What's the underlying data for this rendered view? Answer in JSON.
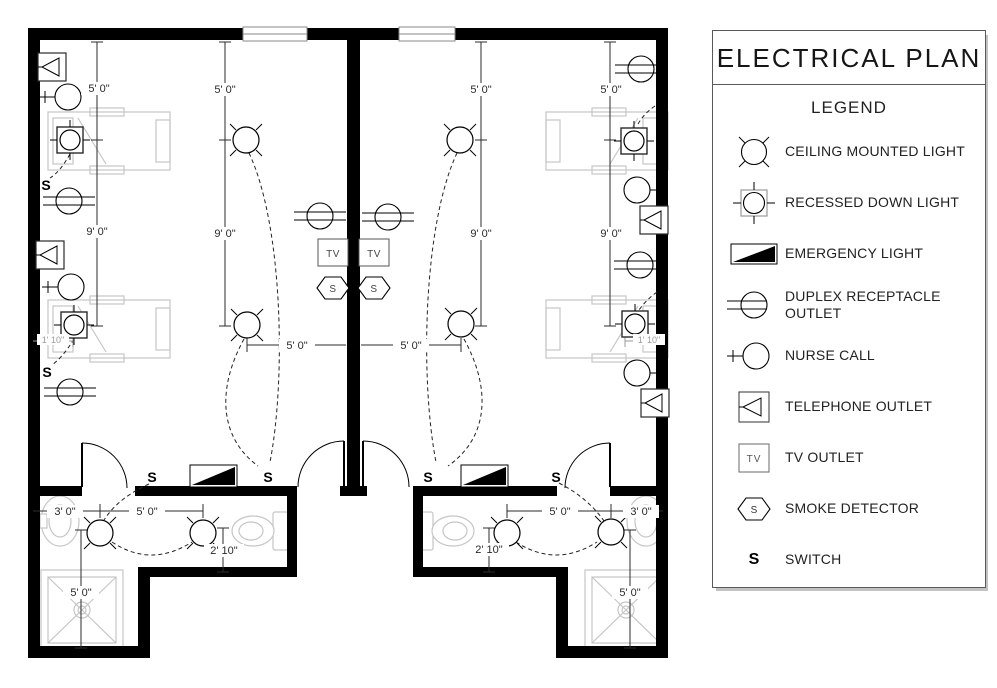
{
  "legend": {
    "title": "ELECTRICAL PLAN",
    "heading": "LEGEND",
    "items": [
      {
        "symbol": "ceiling-mounted-light",
        "label": "CEILING MOUNTED LIGHT"
      },
      {
        "symbol": "recessed-down-light",
        "label": "RECESSED DOWN LIGHT"
      },
      {
        "symbol": "emergency-light",
        "label": "EMERGENCY LIGHT"
      },
      {
        "symbol": "duplex-receptacle-outlet",
        "label": "DUPLEX RECEPTACLE OUTLET"
      },
      {
        "symbol": "nurse-call",
        "label": "NURSE CALL"
      },
      {
        "symbol": "telephone-outlet",
        "label": "TELEPHONE OUTLET"
      },
      {
        "symbol": "tv-outlet",
        "label": "TV OUTLET"
      },
      {
        "symbol": "smoke-detector",
        "label": "SMOKE DETECTOR"
      },
      {
        "symbol": "switch",
        "label": "SWITCH"
      }
    ],
    "tv_glyph": "TV",
    "smoke_glyph": "S",
    "switch_glyph": "S"
  },
  "plan": {
    "tv_glyph": "TV",
    "smoke_glyph": "S",
    "switch_glyph": "S",
    "dims": [
      {
        "text": "5' 0\""
      },
      {
        "text": "9' 0\""
      },
      {
        "text": "5' 0\""
      },
      {
        "text": "9' 0\""
      },
      {
        "text": "5' 0\""
      },
      {
        "text": "9' 0\""
      },
      {
        "text": "5' 0\""
      },
      {
        "text": "9' 0\""
      },
      {
        "text": "5' 0\""
      },
      {
        "text": "5' 0\""
      },
      {
        "text": "3' 0\""
      },
      {
        "text": "5' 0\""
      },
      {
        "text": "2' 10\""
      },
      {
        "text": "5' 0\""
      },
      {
        "text": "5' 0\""
      },
      {
        "text": "3' 0\""
      },
      {
        "text": "2' 10\""
      },
      {
        "text": "5' 0\""
      },
      {
        "text": "1' 10\""
      },
      {
        "text": "1' 10\""
      }
    ]
  },
  "colors": {
    "wall": "#000000",
    "line": "#2b2b2b",
    "furniture": "#c6c6c6",
    "dim_text": "#2b2b2b",
    "dim_text_small": "#9a9a9a",
    "panel_border": "#5a5a5a",
    "panel_shadow": "#c2c2c2",
    "background": "#ffffff"
  }
}
